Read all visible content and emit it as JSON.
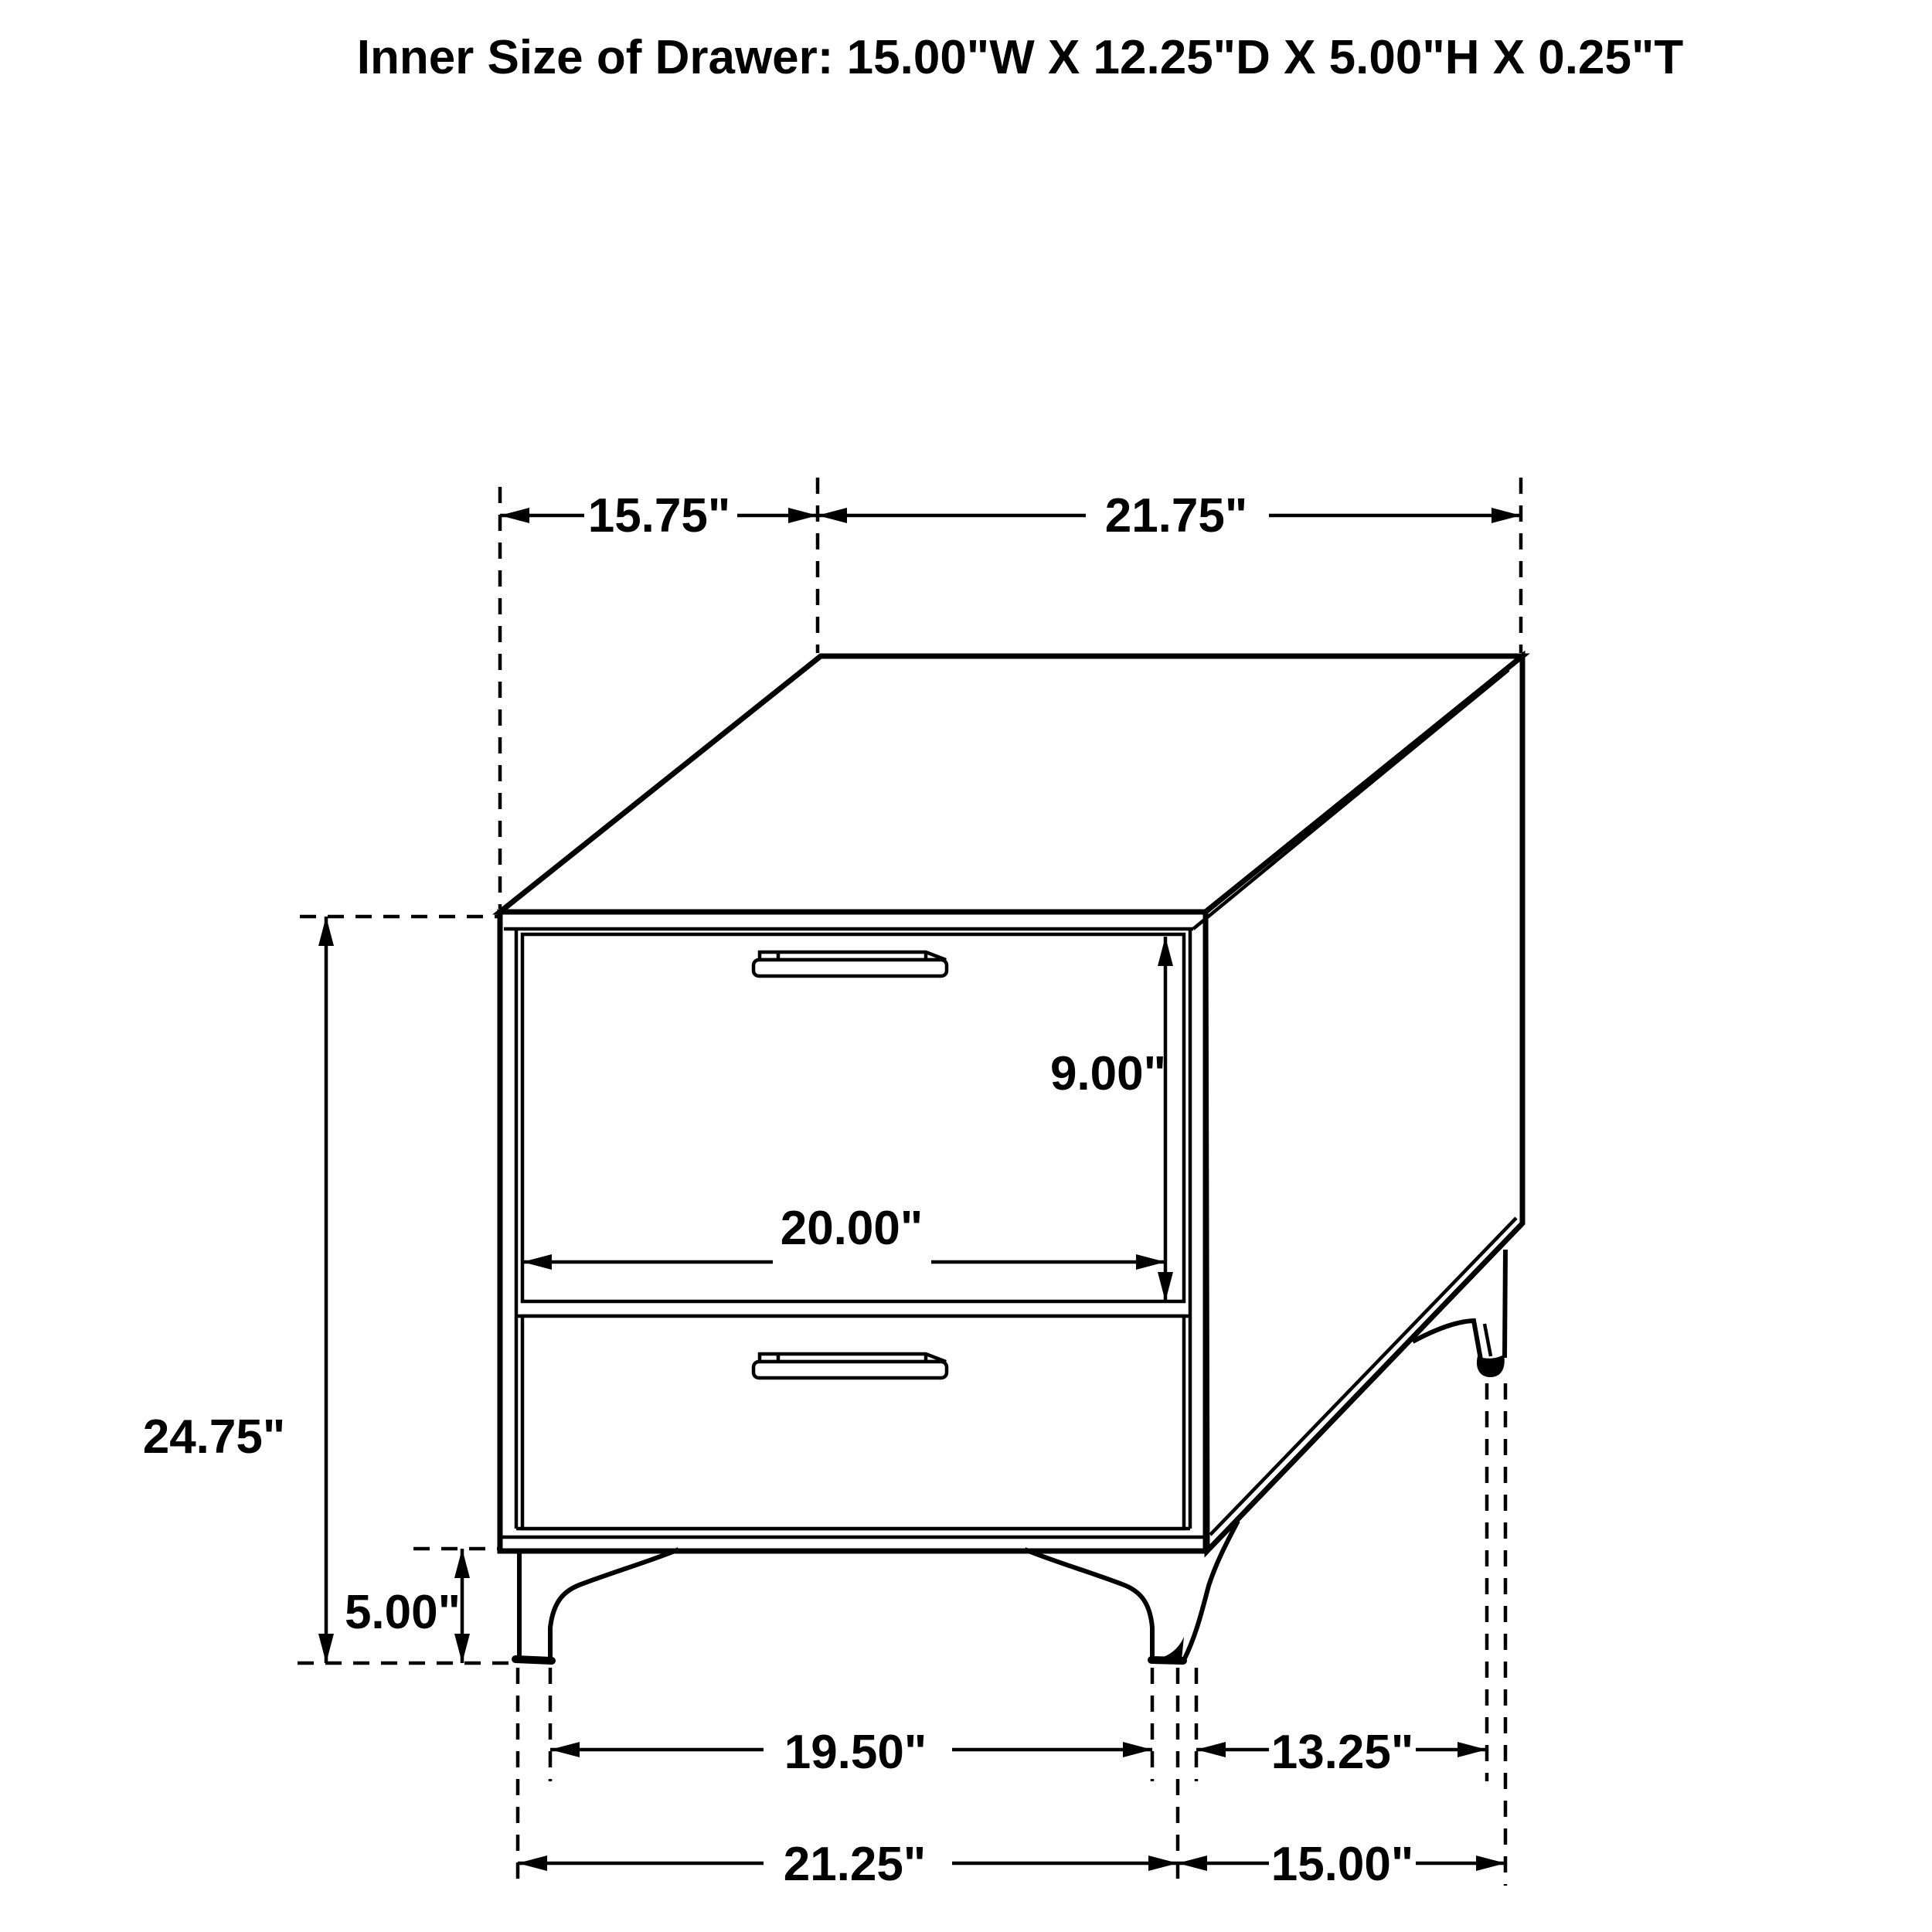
{
  "title": "Inner Size of Drawer: 15.00\"W X 12.25\"D X 5.00\"H X 0.25\"T",
  "inner_drawer_size": {
    "width": "15.00\"W",
    "depth": "12.25\"D",
    "height": "5.00\"H",
    "thickness": "0.25\"T"
  },
  "dimensions": {
    "top_depth_label": "15.75\"",
    "top_width_label": "21.75\"",
    "overall_height_label": "24.75\"",
    "drawer_front_height_label": "9.00\"",
    "drawer_front_width_label": "20.00\"",
    "leg_height_label": "5.00\"",
    "front_feet_inner_span_label": "19.50\"",
    "side_feet_span_label": "13.25\"",
    "front_width_label": "21.25\"",
    "side_depth_label": "15.00\""
  },
  "colors": {
    "line": "#000000",
    "background": "#ffffff"
  }
}
